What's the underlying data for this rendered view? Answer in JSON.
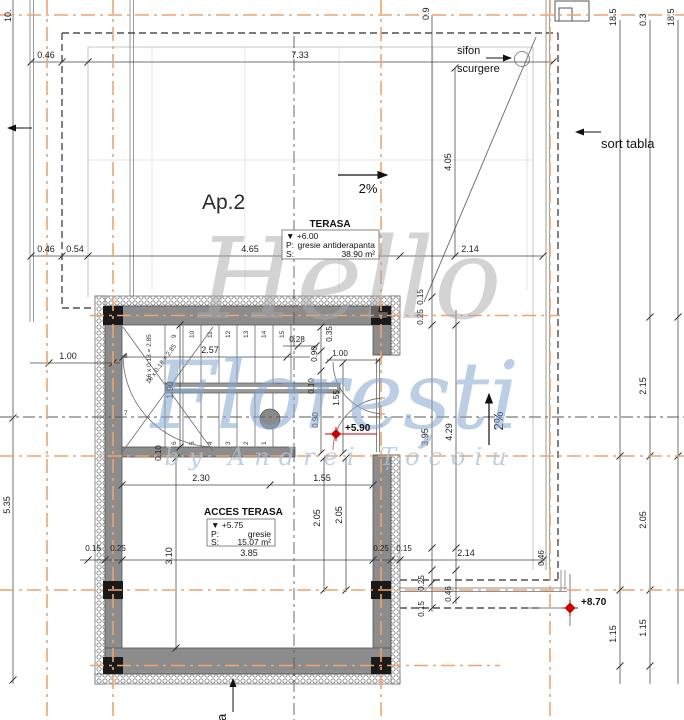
{
  "drawing": {
    "apartment_label": "Ap.2",
    "slope_top": "2%",
    "slope_right": "2%",
    "drain_label_line1": "sifon",
    "drain_label_line2": "scurgere",
    "sort_tabla_label": "sort tabla",
    "bottom_edge_label": "tabla",
    "stair_formula": "16 x 0.18 = 2.85",
    "level_stair": "+5.90",
    "level_roof": "+8.70"
  },
  "terasa_box": {
    "title": "TERASA",
    "level": "▼ +6.00",
    "p_label": "P:",
    "p_value": "gresie antiderapanta",
    "s_label": "S:",
    "s_value": "38.90 m²"
  },
  "acces_box": {
    "title": "ACCES TERASA",
    "level": "▼ +5.75",
    "p_label": "P:",
    "p_value": "gresie",
    "s_label": "S:",
    "s_value": "15.07 m²"
  },
  "watermark": {
    "word1": "Hello",
    "word2": "Florești",
    "byline": "by Andrei Țocoiu"
  },
  "stairs": {
    "numbers": [
      "1",
      "2",
      "3",
      "4",
      "5",
      "6",
      "7",
      "8",
      "9",
      "10",
      "11",
      "12",
      "13",
      "14",
      "15"
    ]
  },
  "dims": {
    "top_046": "0.46",
    "top_733": "7.33",
    "mid_046": "0.46",
    "mid_054": "0.54",
    "mid_465": "4.65",
    "mid_214": "2.14",
    "v_405": "4.05",
    "v_09": "0.9",
    "v_185a": "18.5",
    "v_03": "0.3",
    "v_185b": "18.5",
    "left_10": "10.",
    "left_535": "5.35",
    "left_100": "1.00",
    "r_215": "2.15",
    "r_205": "2.05",
    "r_115a": "1.15",
    "r_115b": "1.15",
    "r_395": "3.95",
    "r_429": "4.29",
    "s_257": "2.57",
    "s_190": "1.90",
    "s_028": "0.28",
    "s_035": "0.35",
    "s_090a": "0.90",
    "s_100": "1.00",
    "s_010a": "0.10",
    "s_155": "1.55",
    "s_090b": "0.90",
    "s_010b": "0.10",
    "a_230": "2.30",
    "a_155": "1.55",
    "a_205a": "2.05",
    "a_205b": "2.05",
    "a_310": "3.10",
    "a_385": "3.85",
    "b_015l": "0.15",
    "b_025l": "0.25",
    "b_025r": "0.25",
    "b_015r": "0.15",
    "b_214": "2.14",
    "rt_015": "0.15",
    "rt_025": "0.25",
    "rb_025": "0.25",
    "rb_015": "0.15",
    "rb_046": "0.46",
    "edge_046": "0.46"
  }
}
